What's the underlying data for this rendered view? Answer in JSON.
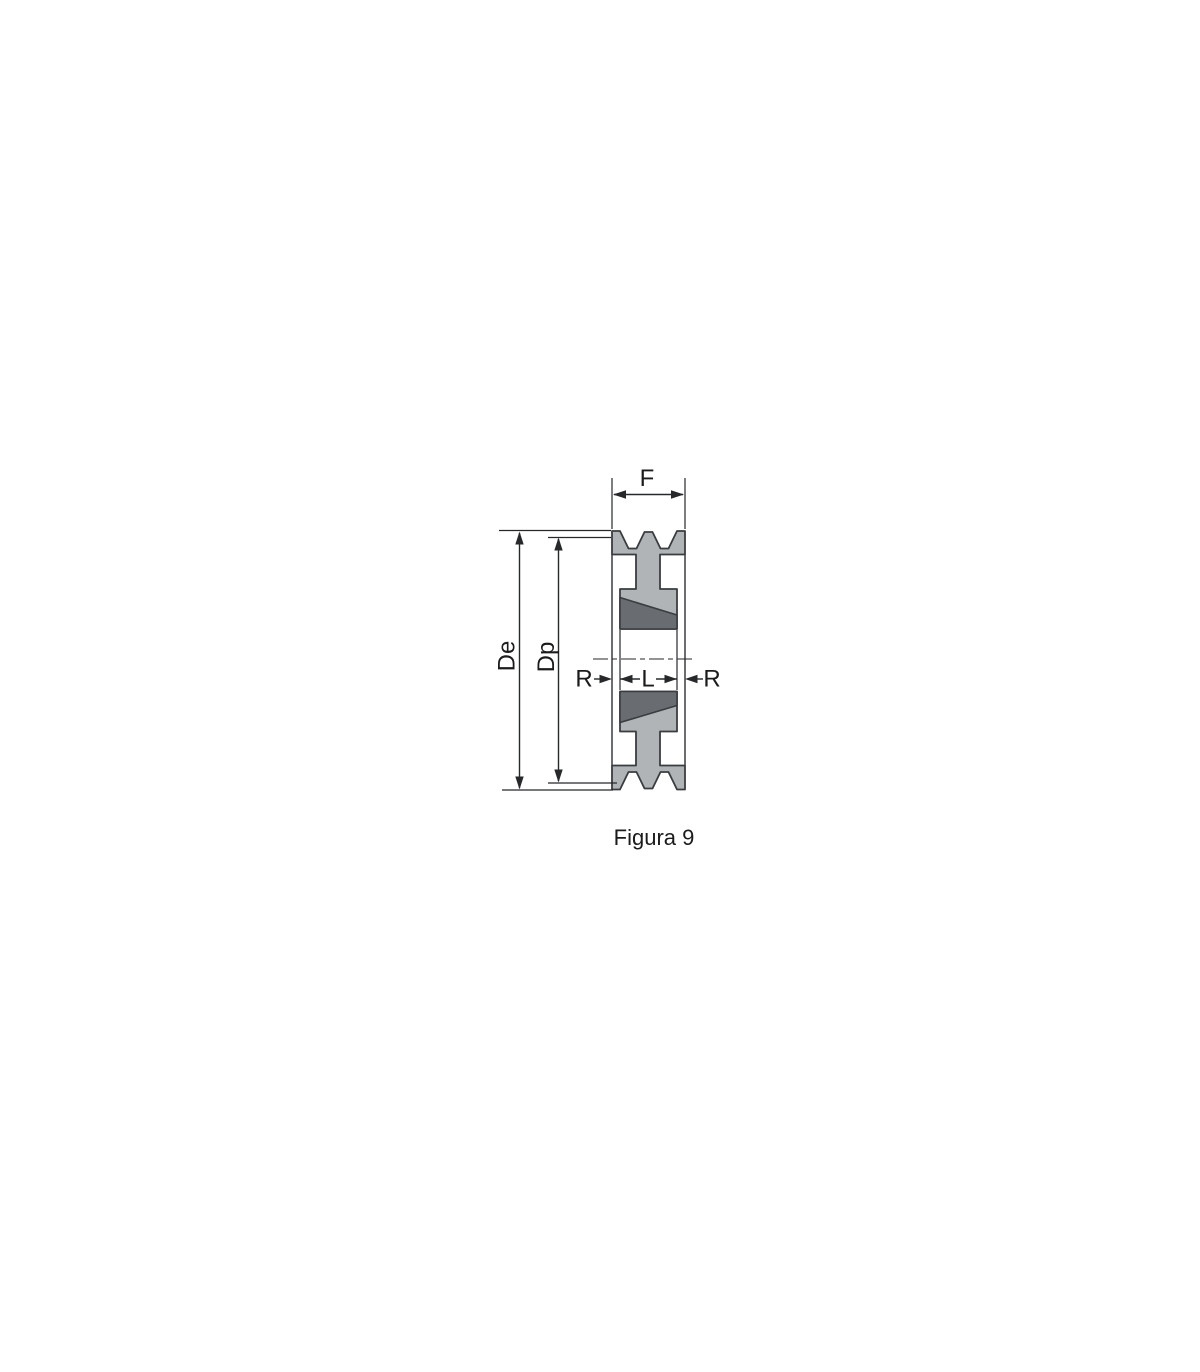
{
  "caption": "Figura 9",
  "dimensions": {
    "f": "F",
    "de": "De",
    "dp": "Dp",
    "r_left": "R",
    "l": "L",
    "r_right": "R"
  },
  "colors": {
    "background": "#ffffff",
    "body_fill": "#b1b4b7",
    "bushing_fill": "#696d71",
    "outline": "#3a3d40",
    "dimension": "#26282a",
    "text": "#1b1b1b"
  }
}
